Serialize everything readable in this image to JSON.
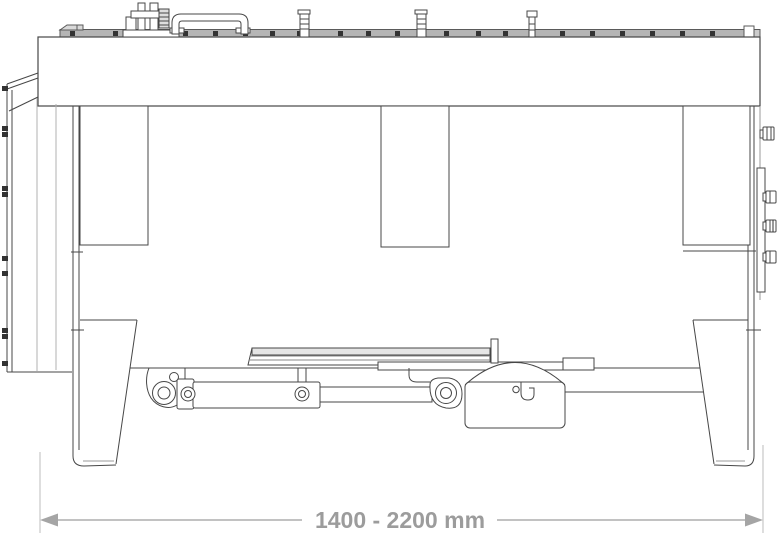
{
  "page": {
    "background": "#ffffff"
  },
  "drawing": {
    "kind": "technical-line-drawing",
    "subject": "rear view of adjustable-width implement with side-shift hydraulic cylinder and skids",
    "line_color": "#474747",
    "light_line_color": "#a8a8a8",
    "rail_fill": "#b5b5b5"
  },
  "dimension": {
    "label": "1400 - 2200 mm",
    "line_color": "#c2c2c2",
    "extension_line_color": "#d2d2d2",
    "arrow_color": "#a5a5a5",
    "text_color": "#9c9c9c"
  }
}
